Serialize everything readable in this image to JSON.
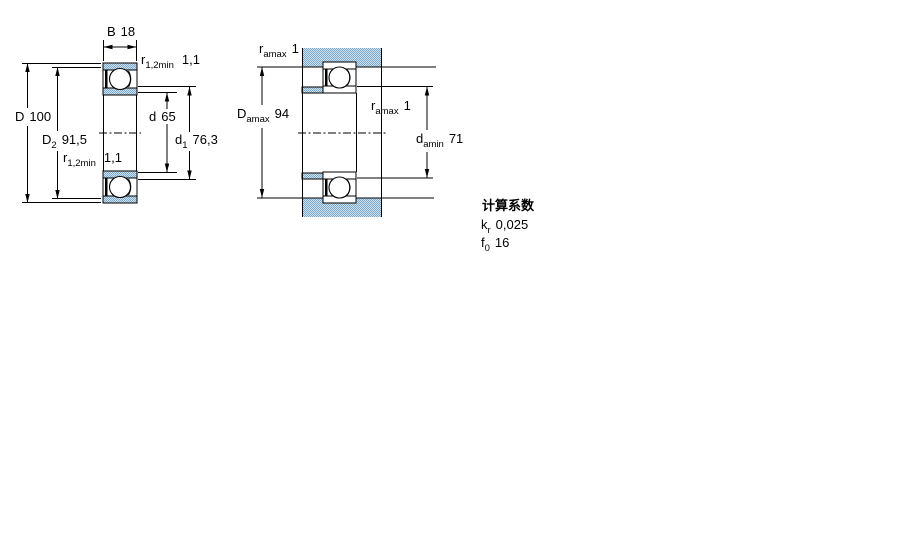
{
  "figure_left": {
    "name": "bearing cross-section with boundary dimensions",
    "dims": {
      "B": {
        "symbol": "B",
        "sub": "",
        "value": "18"
      },
      "r_top": {
        "symbol": "r",
        "sub": "1,2min",
        "value": "1,1"
      },
      "D": {
        "symbol": "D",
        "sub": "",
        "value": "100"
      },
      "D2": {
        "symbol": "D",
        "sub": "2",
        "value": "91,5"
      },
      "r_bottom": {
        "symbol": "r",
        "sub": "1,2min",
        "value": "1,1"
      },
      "d": {
        "symbol": "d",
        "sub": "",
        "value": "65"
      },
      "d1": {
        "symbol": "d",
        "sub": "1",
        "value": "76,3"
      }
    }
  },
  "figure_right": {
    "name": "mounting / abutment dimensions",
    "dims": {
      "ra_top": {
        "symbol": "r",
        "sub": "amax",
        "value": "1"
      },
      "Da": {
        "symbol": "D",
        "sub": "amax",
        "value": "94"
      },
      "ra_mid": {
        "symbol": "r",
        "sub": "amax",
        "value": "1"
      },
      "da": {
        "symbol": "d",
        "sub": "amin",
        "value": "71"
      }
    }
  },
  "calculation_factors": {
    "heading": "计算系数",
    "rows": [
      {
        "symbol": "k",
        "sub": "r",
        "value": "0,025"
      },
      {
        "symbol": "f",
        "sub": "0",
        "value": "16"
      }
    ]
  },
  "colors": {
    "line": "#000000",
    "dither_light": "#cde0ee",
    "dither_dark": "#7fa9cd",
    "background": "#ffffff"
  }
}
